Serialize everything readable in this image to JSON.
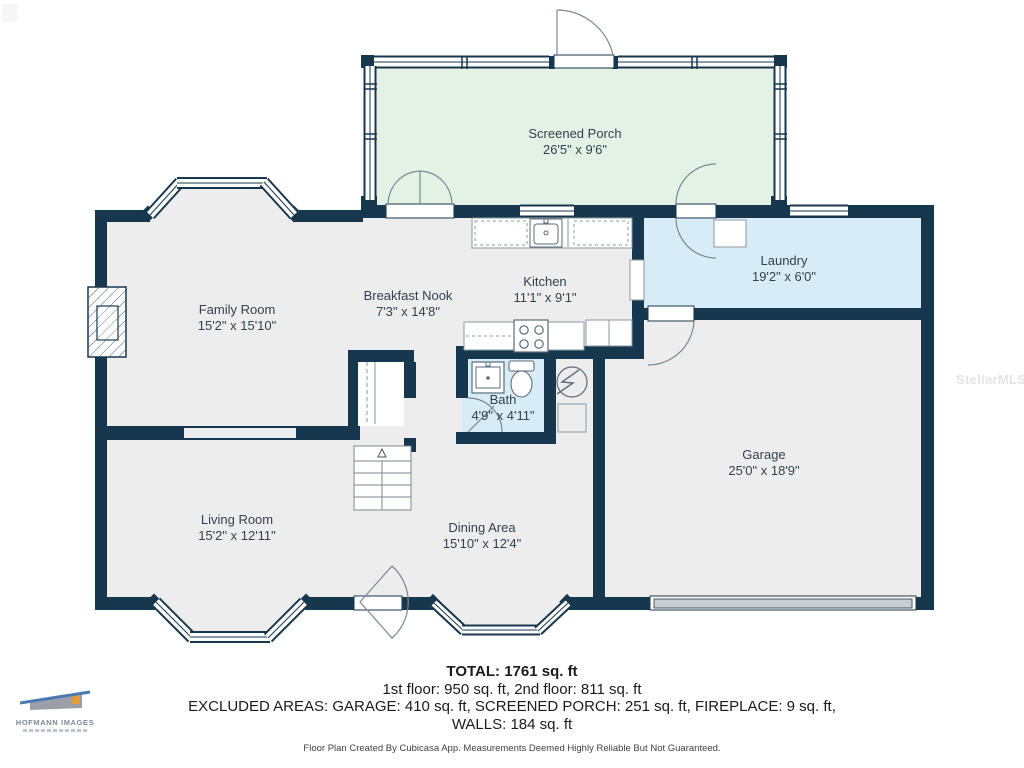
{
  "meta": {
    "title": "First floor plan",
    "canvas_width": 1024,
    "canvas_height": 768
  },
  "colors": {
    "wall": "#17374E",
    "floor": "#EDEDEE",
    "porch_floor": "#E3F2E5",
    "wet_room_floor": "#D8ECF8",
    "garage_door": "#C9CED3",
    "room_label": "#33414F",
    "summary_text": "#1B1B1B",
    "watermark": "#E4E4E4"
  },
  "rooms": [
    {
      "id": "screened-porch",
      "label": "Screened Porch",
      "dims": "26'5\" x 9'6\""
    },
    {
      "id": "family-room",
      "label": "Family Room",
      "dims": "15'2\" x 15'10\""
    },
    {
      "id": "breakfast-nook",
      "label": "Breakfast Nook",
      "dims": "7'3\" x 14'8\""
    },
    {
      "id": "kitchen",
      "label": "Kitchen",
      "dims": "11'1\" x 9'1\""
    },
    {
      "id": "laundry",
      "label": "Laundry",
      "dims": "19'2\" x 6'0\""
    },
    {
      "id": "bath",
      "label": "Bath",
      "dims": "4'9\" x 4'11\""
    },
    {
      "id": "garage",
      "label": "Garage",
      "dims": "25'0\" x 18'9\""
    },
    {
      "id": "living-room",
      "label": "Living Room",
      "dims": "15'2\" x 12'11\""
    },
    {
      "id": "dining-area",
      "label": "Dining Area",
      "dims": "15'10\" x 12'4\""
    }
  ],
  "summary": {
    "total": "TOTAL: 1761 sq. ft",
    "floors": "1st floor: 950 sq. ft, 2nd floor: 811 sq. ft",
    "excluded": "EXCLUDED AREAS: GARAGE: 410 sq. ft, SCREENED PORCH: 251 sq. ft, FIREPLACE: 9 sq. ft,",
    "walls": "WALLS: 184 sq. ft",
    "disclaimer": "Floor Plan Created By Cubicasa App. Measurements Deemed Highly Reliable But Not Guaranteed."
  },
  "watermarks": {
    "mls": "StellarMLS",
    "logo_title": "HOFMANN IMAGES"
  },
  "icons": [
    "fireplace-icon",
    "stairs-icon",
    "kitchen-sink-icon",
    "stove-icon",
    "fridge-icon",
    "washer-icon",
    "bath-sink-icon",
    "toilet-icon",
    "water-heater-icon",
    "door-arc-icon",
    "window-icon",
    "garage-door-icon"
  ]
}
